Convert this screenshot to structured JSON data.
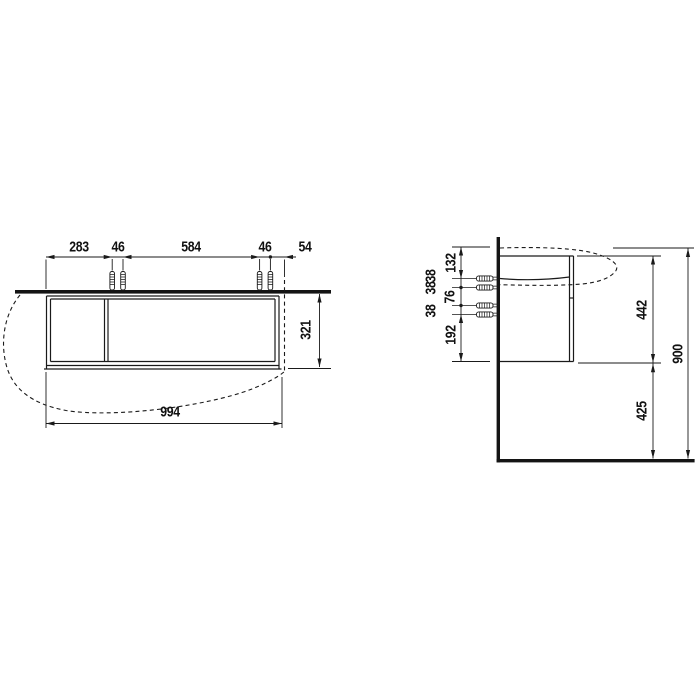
{
  "drawing": {
    "front_view": {
      "top_dims": [
        "283",
        "46",
        "584",
        "46",
        "54"
      ],
      "width": "994",
      "height": "321"
    },
    "side_view": {
      "left_dims": [
        "132",
        "38",
        "38",
        "76",
        "38",
        "192"
      ],
      "right_dims": [
        "442",
        "425",
        "900"
      ]
    },
    "colors": {
      "line": "#1a1a1a",
      "background": "#ffffff"
    }
  }
}
